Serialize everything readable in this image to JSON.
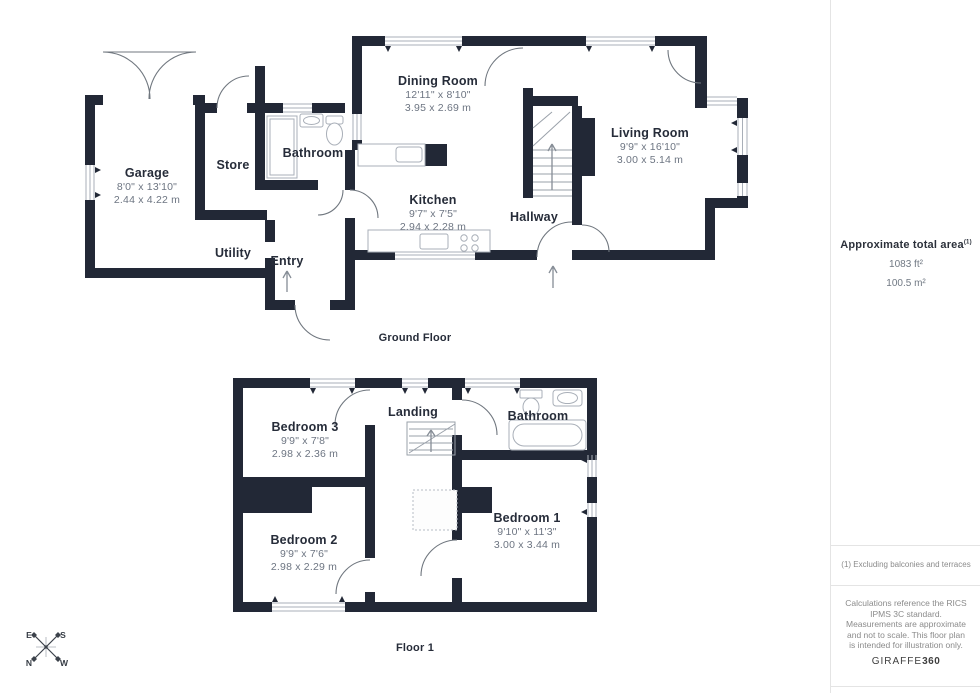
{
  "ground_floor": {
    "label": "Ground Floor",
    "rooms": [
      {
        "name": "Garage",
        "imperial": "8'0\" x 13'10\"",
        "metric": "2.44 x 4.22 m"
      },
      {
        "name": "Store"
      },
      {
        "name": "Bathroom"
      },
      {
        "name": "Utility"
      },
      {
        "name": "Entry"
      },
      {
        "name": "Dining Room",
        "imperial": "12'11\" x 8'10\"",
        "metric": "3.95 x 2.69 m"
      },
      {
        "name": "Kitchen",
        "imperial": "9'7\" x 7'5\"",
        "metric": "2.94 x 2.28 m"
      },
      {
        "name": "Hallway"
      },
      {
        "name": "Living Room",
        "imperial": "9'9\" x 16'10\"",
        "metric": "3.00 x 5.14 m"
      }
    ]
  },
  "floor_1": {
    "label": "Floor 1",
    "rooms": [
      {
        "name": "Bedroom 3",
        "imperial": "9'9\" x 7'8\"",
        "metric": "2.98 x 2.36 m"
      },
      {
        "name": "Landing"
      },
      {
        "name": "Bathroom"
      },
      {
        "name": "Bedroom 2",
        "imperial": "9'9\" x 7'6\"",
        "metric": "2.98 x 2.29 m"
      },
      {
        "name": "Bedroom 1",
        "imperial": "9'10\" x 11'3\"",
        "metric": "3.00 x 3.44 m"
      }
    ]
  },
  "sidebar": {
    "area_title": "Approximate total area",
    "area_footnote_marker": "(1)",
    "area_imperial": "1083 ft²",
    "area_metric": "100.5 m²",
    "footnote": "(1) Excluding balconies and terraces",
    "disclaimer": "Calculations reference the RICS IPMS 3C standard. Measurements are approximate and not to scale. This floor plan is intended for illustration only.",
    "brand_name": "GIRAFFE",
    "brand_suffix": "360"
  },
  "compass": {
    "north": "N",
    "south": "S",
    "east": "E",
    "west": "W"
  },
  "colors": {
    "wall": "#222836",
    "dim_text": "#6d7582",
    "divider": "#e4e4e4"
  }
}
